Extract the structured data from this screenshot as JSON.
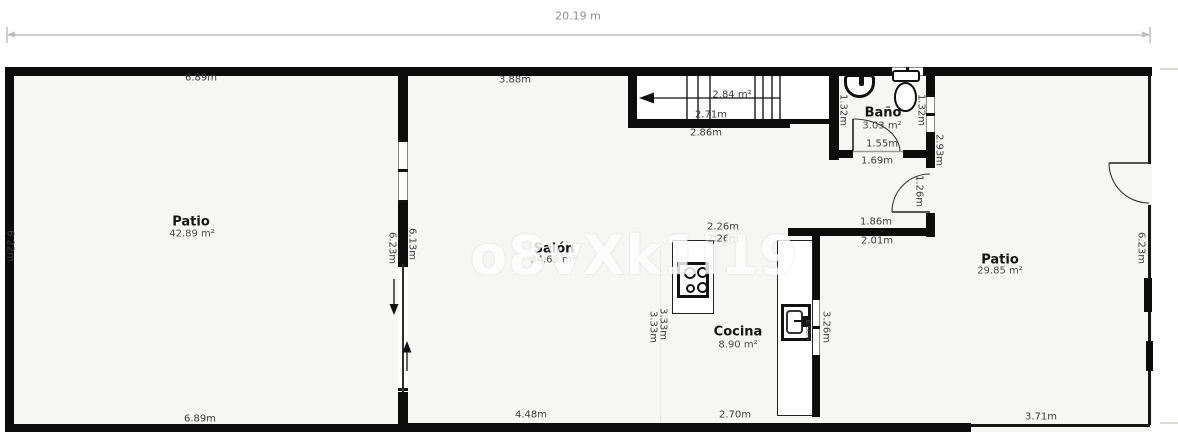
{
  "plan": {
    "top_dimension_label": "20.19 m",
    "watermark": "o8vXk1i19",
    "rooms": {
      "patio_left": {
        "name": "Patio",
        "area": "42.89 m²"
      },
      "salon": {
        "name": "Salón",
        "area": "34.69 m²"
      },
      "cocina": {
        "name": "Cocina",
        "area": "8.90 m²"
      },
      "bano": {
        "name": "Baño",
        "area": "3.03 m²"
      },
      "patio_right": {
        "name": "Patio",
        "area": "29.85 m²"
      }
    },
    "dims": {
      "patio_left_top": "6.89m",
      "salon_top": "3.88m",
      "stairs_area": "2.84 m²",
      "stairs_width": "2.71m",
      "stairs_below": "2.86m",
      "bano_inner_width": "1.55m",
      "bano_outer_width": "1.69m",
      "bano_left_height": "1.32m",
      "bano_right_height": "1.32m",
      "bano_wall_height": "2.93m",
      "hall_door": "1.26m",
      "hall_width_top": "1.86m",
      "hall_width_bottom": "2.01m",
      "kitchen_top_a": "2.26m",
      "kitchen_top_b": "2.26m",
      "patio_left_side": "6.22m",
      "midwall_patio_side": "6.23m",
      "midwall_salon_side": "6.13m",
      "kitchen_left_a": "3.33m",
      "kitchen_left_b": "3.33m",
      "kitchen_wall_right": "3.26m",
      "counter_depth": "0.60m",
      "patio_right_side": "6.23m",
      "patio_left_bottom": "6.89m",
      "salon_bottom": "4.48m",
      "cocina_bottom": "2.70m",
      "patio_right_bottom": "3.71m"
    }
  }
}
